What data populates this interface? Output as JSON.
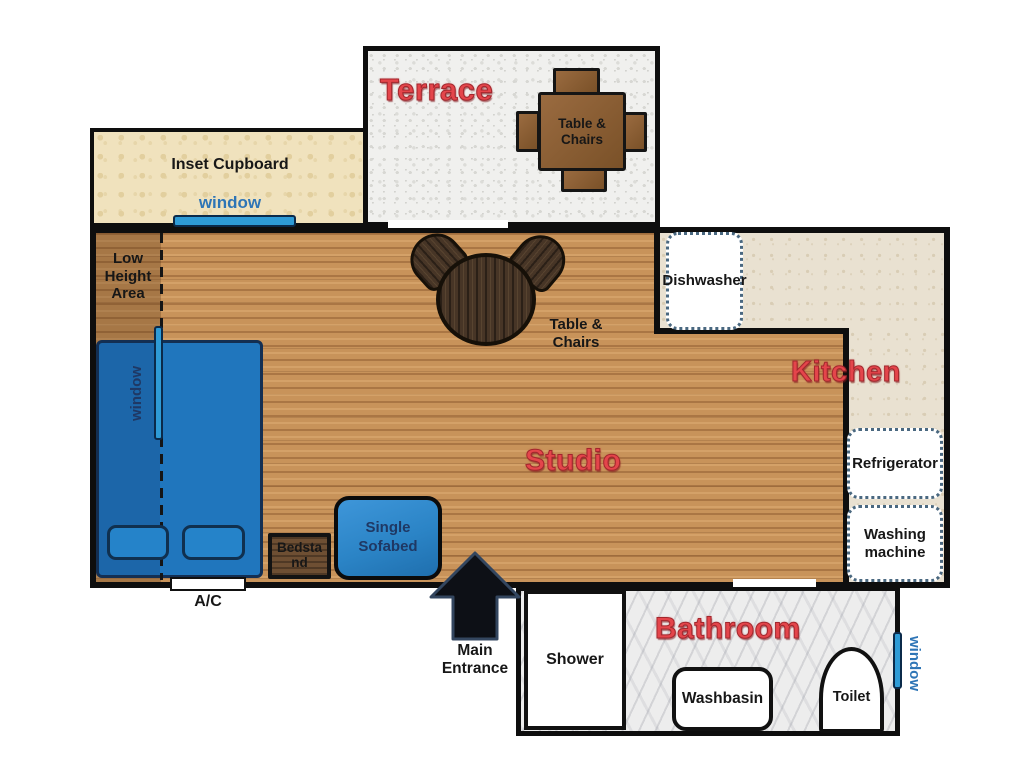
{
  "title": "Studio apartment floor plan",
  "rooms": {
    "terrace": {
      "label": "Terrace"
    },
    "inset_cupboard": {
      "label": "Inset Cupboard",
      "window_label": "window"
    },
    "studio": {
      "label": "Studio",
      "low_height_area": "Low Height Area"
    },
    "kitchen": {
      "label": "Kitchen"
    },
    "bathroom": {
      "label": "Bathroom",
      "window_label": "window"
    }
  },
  "furniture": {
    "terrace_table": {
      "label": "Table & Chairs"
    },
    "studio_table": {
      "label": "Table & Chairs"
    },
    "bed": {
      "window_label": "window"
    },
    "bedstand": {
      "label": "Bedstand"
    },
    "sofabed": {
      "label": "Single Sofabed"
    },
    "ac": {
      "label": "A/C"
    },
    "dishwasher": {
      "label": "Dishwasher"
    },
    "refrigerator": {
      "label": "Refrigerator"
    },
    "washing_machine": {
      "label": "Washing machine"
    },
    "shower": {
      "label": "Shower"
    },
    "washbasin": {
      "label": "Washbasin"
    },
    "toilet": {
      "label": "Toilet"
    }
  },
  "entrance": {
    "label": "Main Entrance"
  },
  "colors": {
    "room_label_red": "#E4454B",
    "window_blue_text": "#2E75B6",
    "window_bar_blue": "#2E9BD6",
    "furniture_blue": "#2B84C6",
    "dark_navy_text": "#1F3864",
    "wall_black": "#0E0E0E",
    "wood_floor": "#C8935A",
    "kitchen_floor": "#E9E1D1",
    "cupboard_floor": "#F0E2BD",
    "terrace_floor": "#F0F0EE",
    "bathroom_floor": "#EDEDED",
    "appliance_dotted_border": "#4A6880",
    "terrace_table_brown": "#8A5E39",
    "dark_table_walnut": "#473526"
  }
}
